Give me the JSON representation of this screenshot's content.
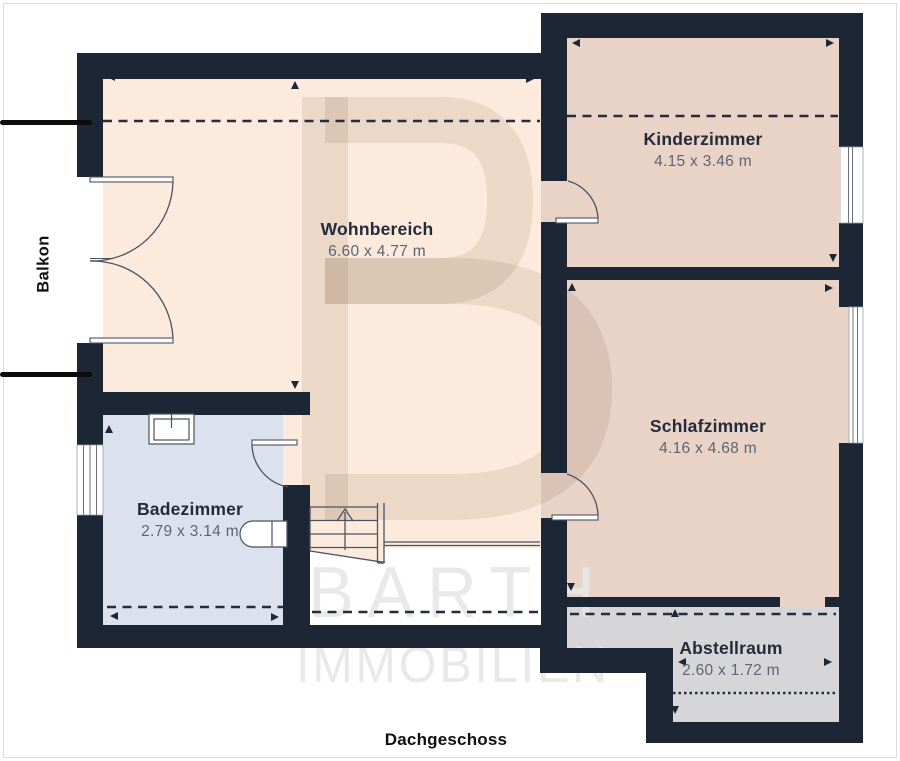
{
  "title": "Dachgeschoss",
  "balcony": {
    "label": "Balkon"
  },
  "watermark": {
    "initial": "B",
    "line1": "BARTH",
    "line2": "IMMOBILIEN"
  },
  "rooms": [
    {
      "name": "Wohnbereich",
      "dims": "6.60 x 4.77 m"
    },
    {
      "name": "Kinderzimmer",
      "dims": "4.15 x 3.46 m"
    },
    {
      "name": "Schlafzimmer",
      "dims": "4.16 x 4.68 m"
    },
    {
      "name": "Badezimmer",
      "dims": "2.79 x 3.14 m"
    },
    {
      "name": "Abstellraum",
      "dims": "2.60 x 1.72 m"
    }
  ],
  "colors": {
    "wall": "#1d2634",
    "floor_living": "#fcebdc",
    "floor_bedrooms": "#e9d3c6",
    "floor_bath": "#dce1ee",
    "floor_storage": "#d6d6d8",
    "line": "#4a5263",
    "watermark_text": "#e7e7e7"
  }
}
